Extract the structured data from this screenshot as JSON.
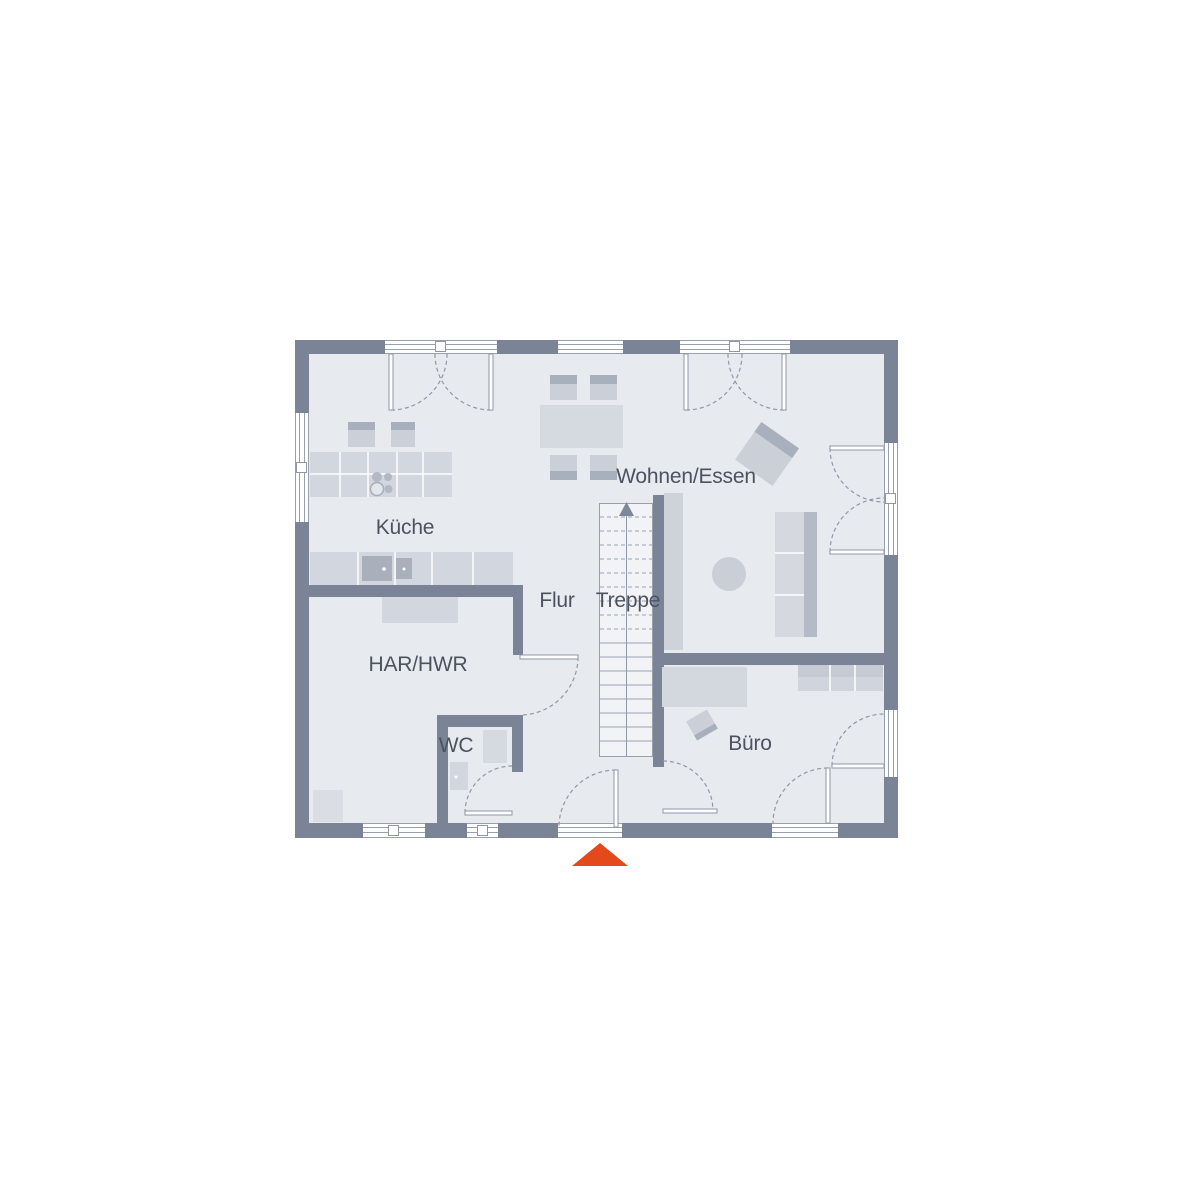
{
  "floor_plan": {
    "kind": "ground-floor architectural plan",
    "rooms": {
      "kueche": {
        "label": "Küche"
      },
      "wohnen_essen": {
        "label": "Wohnen/Essen"
      },
      "flur": {
        "label": "Flur"
      },
      "treppe": {
        "label": "Treppe"
      },
      "har_hwr": {
        "label": "HAR/HWR"
      },
      "wc": {
        "label": "WC"
      },
      "buero": {
        "label": "Büro"
      }
    },
    "entrance_marker": {
      "shape": "triangle-up",
      "color": "#e3491a"
    },
    "stairs": {
      "direction": "up",
      "arrow": "center-line-with-arrowhead"
    },
    "colors": {
      "background": "#ffffff",
      "wall": "#7b8497",
      "floor": "#e7eaee",
      "furniture_light": "#d3d7de",
      "furniture_dark": "#a9b0bc",
      "stair_fill": "#f1f3f6",
      "line": "#8f97a8",
      "label_text": "#4c5260"
    }
  }
}
